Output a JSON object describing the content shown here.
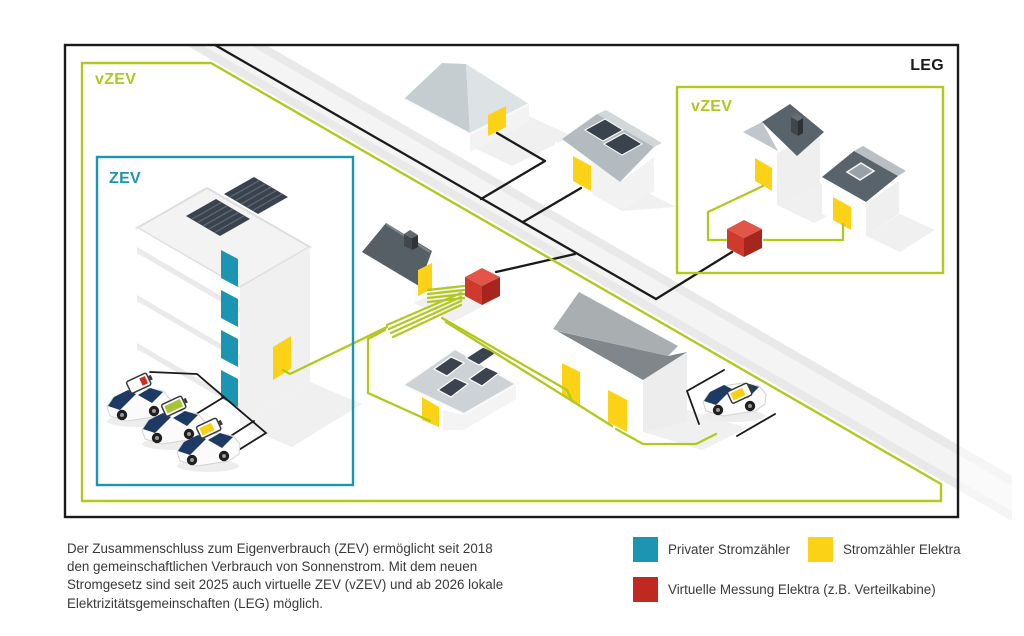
{
  "zones": {
    "leg_label": "LEG",
    "vzev_left_label": "vZEV",
    "zev_label": "ZEV",
    "vzev_right_label": "vZEV"
  },
  "caption": {
    "lines": [
      "Der Zusammenschluss zum Eigenverbrauch (ZEV) ermöglicht seit 2018",
      "den gemeinschaftlichen Verbrauch von Sonnenstrom. Mit dem neuen",
      "Stromgesetz sind seit 2025 auch virtuelle ZEV (vZEV) und ab 2026 lokale",
      "Elektrizitätsgemeinschaften (LEG) möglich."
    ]
  },
  "legend": {
    "items": [
      {
        "label": "Privater Stromzähler",
        "color": "#1b95b1"
      },
      {
        "label": "Stromzähler Elektra",
        "color": "#fbd216"
      },
      {
        "label": "Virtuelle Messung Elektra (z.B. Verteilkabine)",
        "color": "#c02822"
      }
    ]
  },
  "colors": {
    "community_green": "#b2c81e",
    "zev_teal": "#1b95b1",
    "meter_yellow": "#fbd216",
    "virtual_meter_red": "#c02822",
    "grid_line_black": "#1a1a1a"
  }
}
